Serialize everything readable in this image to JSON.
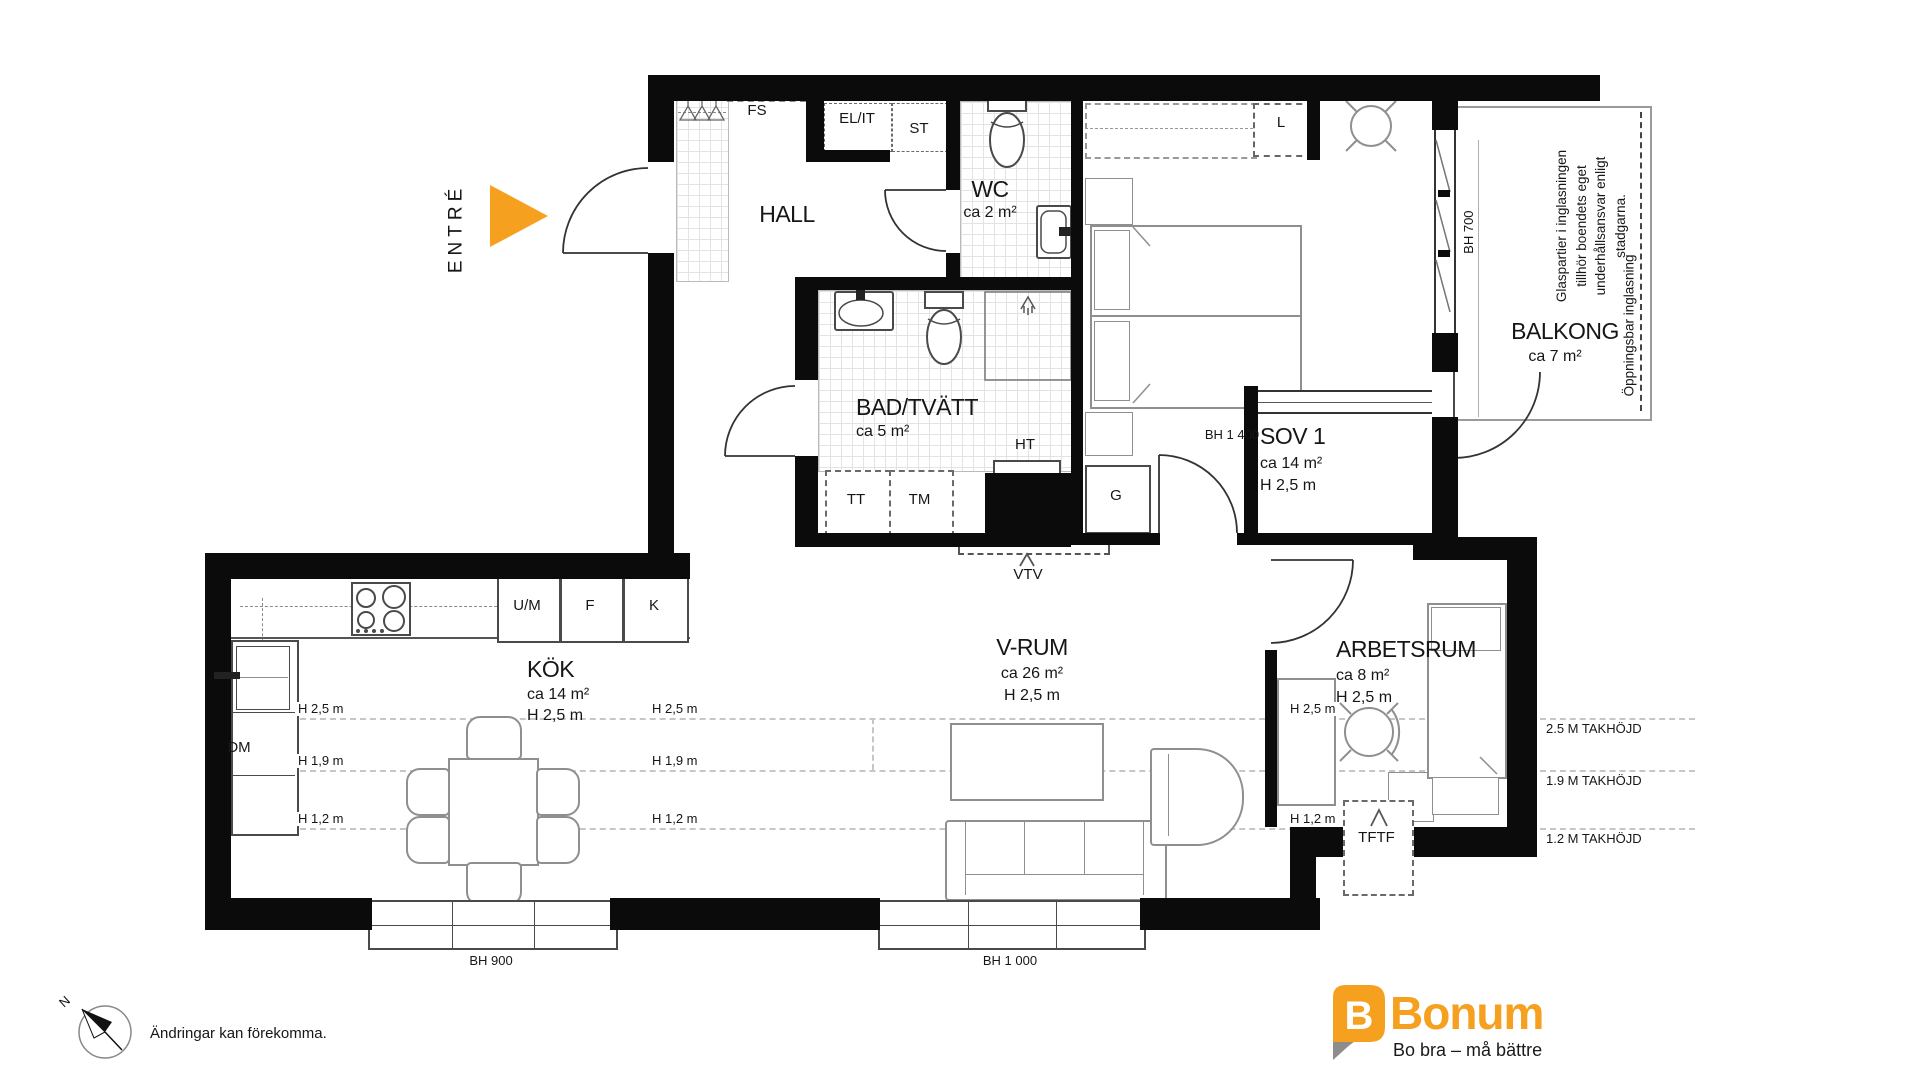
{
  "plan": {
    "entry_label": "ENTRÉ",
    "compass_n": "N",
    "disclaimer": "Ändringar kan förekomma.",
    "rooms": {
      "hall": {
        "name": "HALL"
      },
      "wc": {
        "name": "WC",
        "area": "ca 2 m²"
      },
      "bad": {
        "name": "BAD/TVÄTT",
        "area": "ca 5 m²"
      },
      "sov1": {
        "name": "SOV 1",
        "area": "ca 14 m²",
        "height": "H 2,5 m"
      },
      "kok": {
        "name": "KÖK",
        "area": "ca 14 m²",
        "height": "H 2,5 m"
      },
      "vrum": {
        "name": "V-RUM",
        "area": "ca 26 m²",
        "height": "H 2,5 m"
      },
      "arbetsrum": {
        "name": "ARBETSRUM",
        "area": "ca 8 m²",
        "height": "H 2,5 m"
      },
      "balkong": {
        "name": "BALKONG",
        "area": "ca 7 m²"
      }
    },
    "fixtures": {
      "fs": "FS",
      "el_it": "EL/IT",
      "st": "ST",
      "l": "L",
      "g": "G",
      "um": "U/M",
      "f": "F",
      "k": "K",
      "dm": "DM",
      "tt": "TT",
      "tm": "TM",
      "ht": "HT",
      "vtv": "VTV",
      "tftf": "TFTF"
    },
    "windows": {
      "bh700": "BH 700",
      "bh900": "BH 900",
      "bh1000": "BH 1 000",
      "bh1400": "BH 1 400"
    },
    "heights": {
      "h25": "H 2,5 m",
      "h19": "H 1,9 m",
      "h12": "H 1,2 m"
    },
    "ceiling_legend": {
      "c25": "2.5 M TAKHÖJD",
      "c19": "1.9 M TAKHÖJD",
      "c12": "1.2 M TAKHÖJD"
    },
    "balcony_notes": {
      "glazing_lines": [
        "Glaspartier i inglasningen",
        "tillhör boendets eget",
        "underhållsansvar enligt",
        "stadgarna."
      ],
      "openable": "Öppningsbar inglasning"
    }
  },
  "brand": {
    "logo_letter": "B",
    "name": "Bonum",
    "tagline": "Bo bra – må bättre"
  },
  "colors": {
    "accent_orange": "#F5A01F",
    "wall": "#0B0B0B",
    "furniture_line": "#8F8F8F"
  }
}
